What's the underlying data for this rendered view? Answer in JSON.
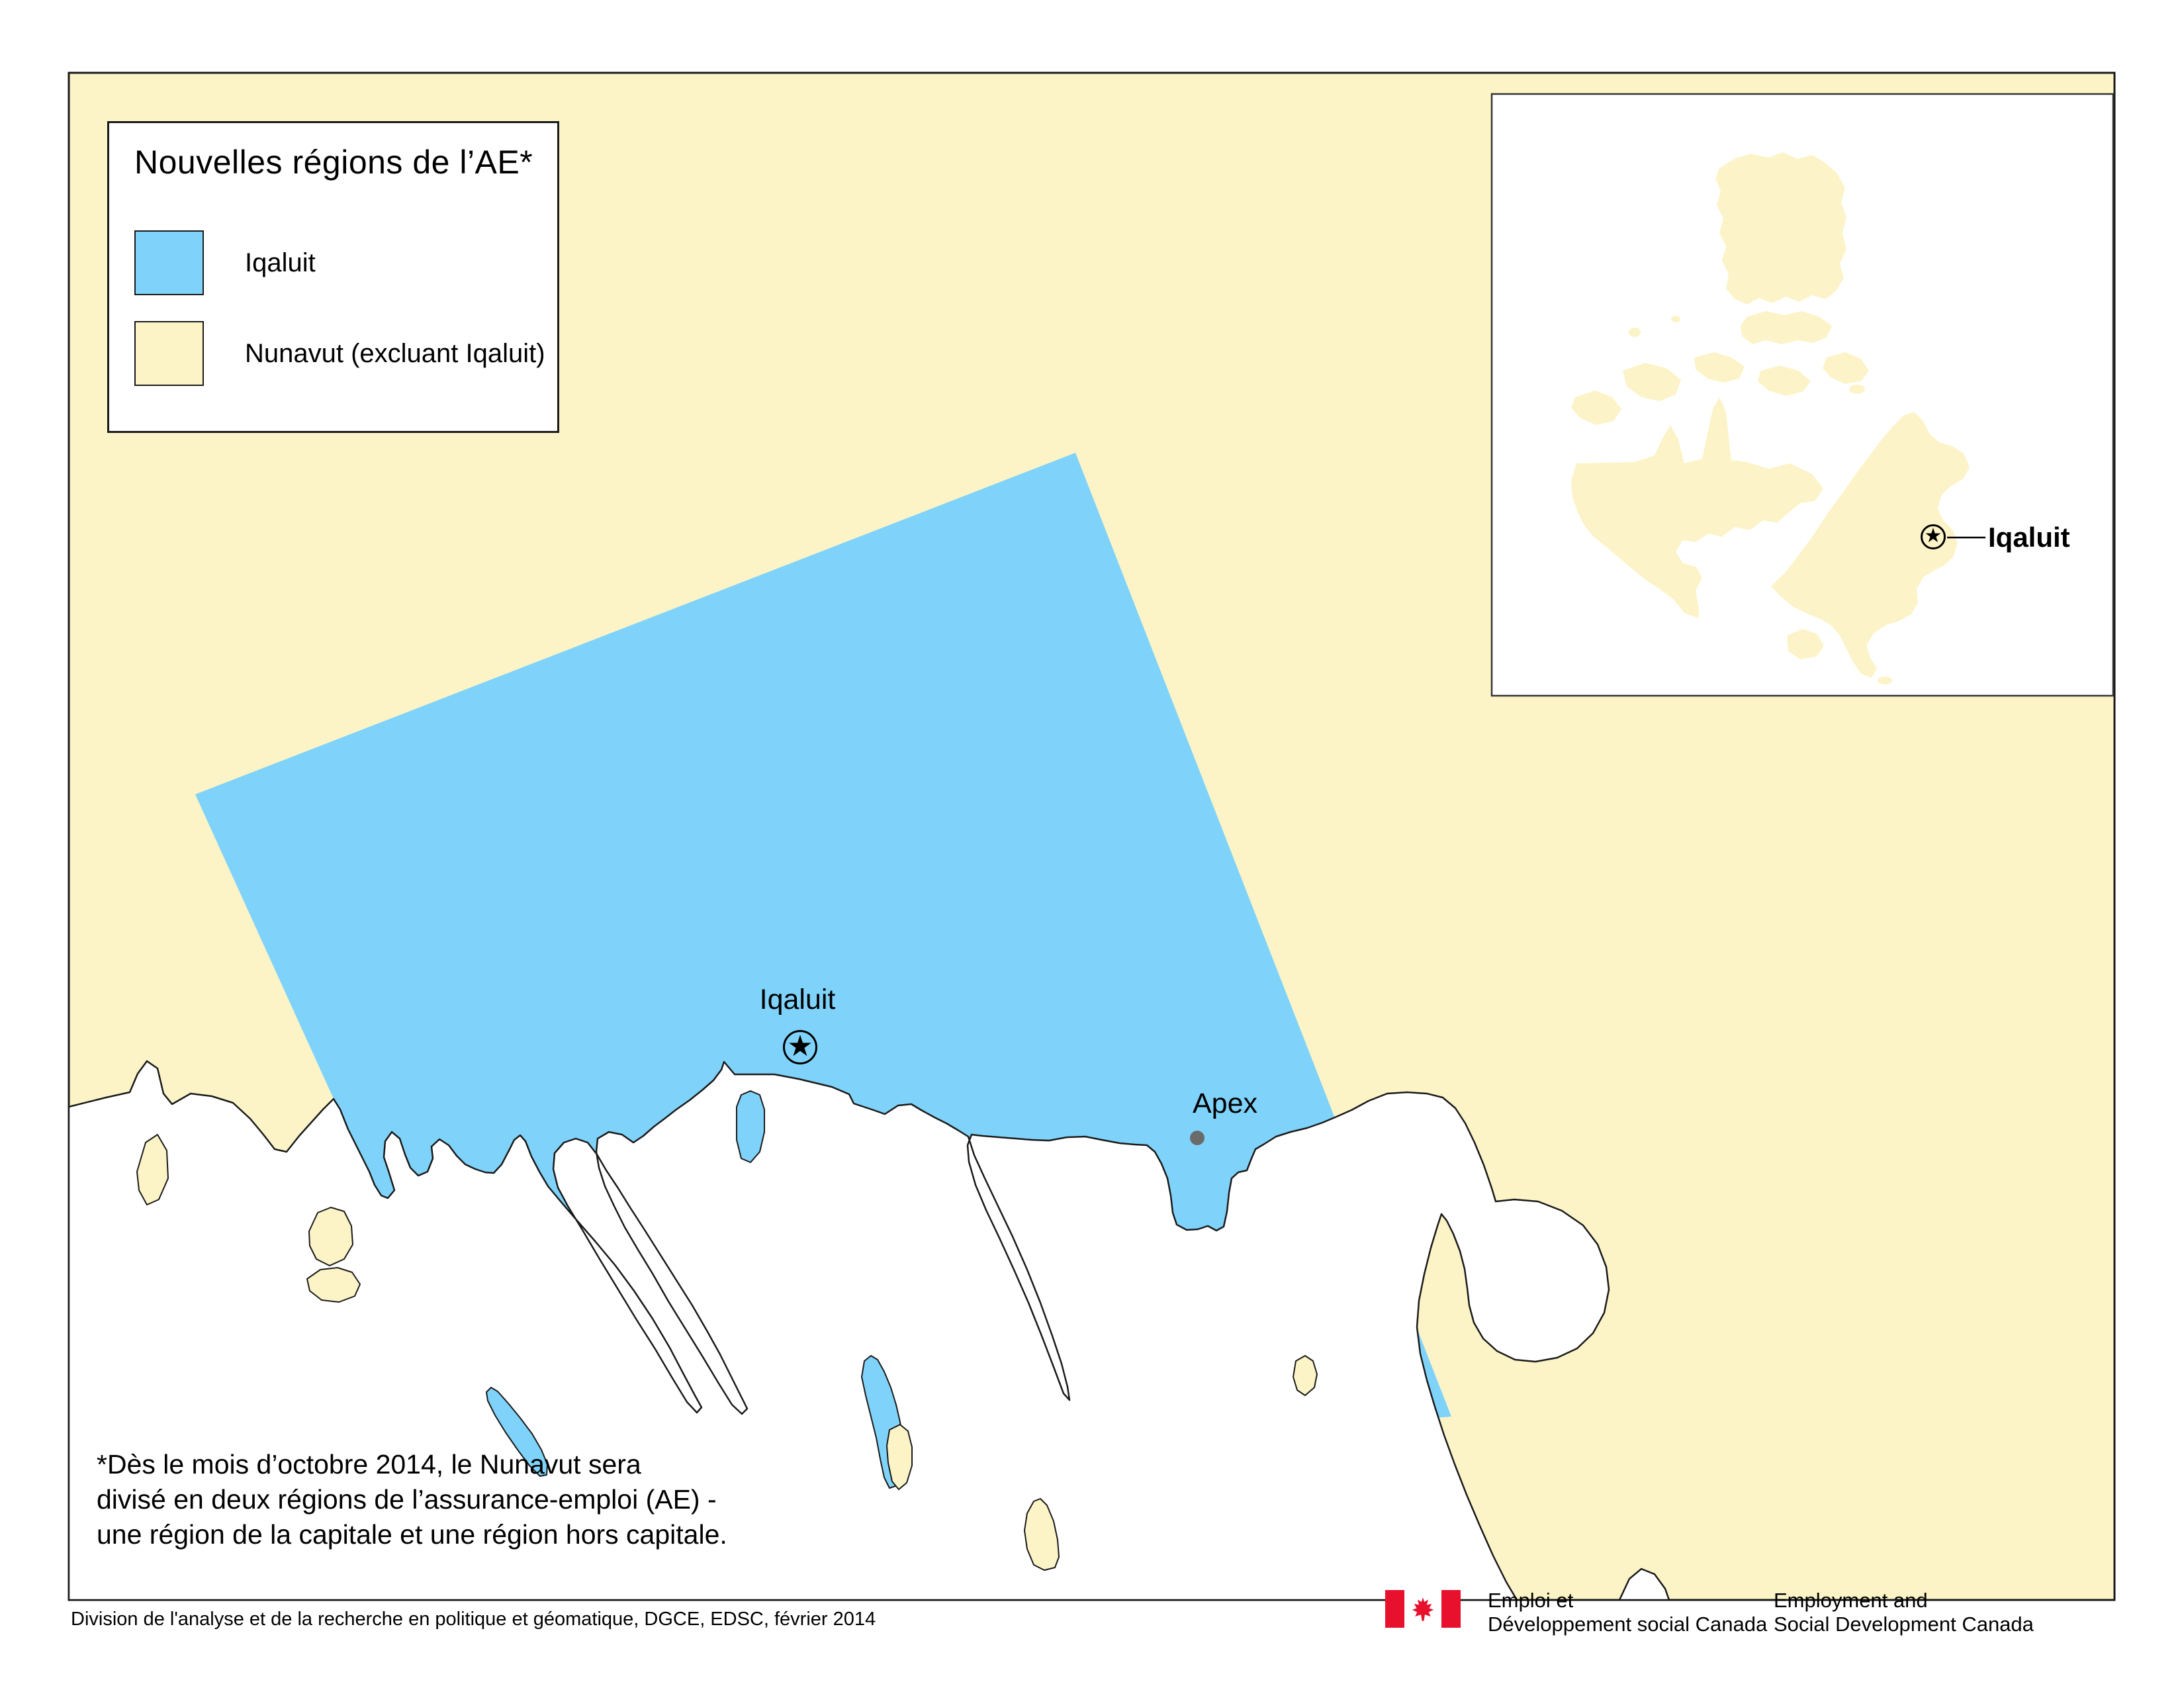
{
  "legend": {
    "title": "Nouvelles régions de l’AE*",
    "items": [
      {
        "label": "Iqaluit",
        "color": "#7FD3FB"
      },
      {
        "label": "Nunavut (excluant Iqaluit)",
        "color": "#FCF4C6"
      }
    ]
  },
  "map": {
    "city_label": "Iqaluit",
    "city_marker": "★",
    "town_label": "Apex"
  },
  "inset": {
    "city_label": "Iqaluit",
    "city_marker": "★"
  },
  "footnote": {
    "lines": [
      "*Dès le mois d’octobre 2014, le Nunavut sera",
      "divisé en deux régions de l’assurance-emploi (AE) -",
      "une région de la capitale et une région hors capitale."
    ]
  },
  "attribution": "Division de l'analyse et de la recherche en politique et géomatique, DGCE, EDSC, février 2014",
  "signature": {
    "fr": [
      "Emploi et",
      "Développement social Canada"
    ],
    "en": [
      "Employment and",
      "Social Development Canada"
    ]
  },
  "colors": {
    "iqaluit_region": "#7FD3FB",
    "nunavut_region": "#FCF4C6",
    "water": "#FFFFFF",
    "coastline": "#1A1A1A",
    "apex_dot": "#6B6B6B",
    "flag_red": "#E8112D"
  }
}
